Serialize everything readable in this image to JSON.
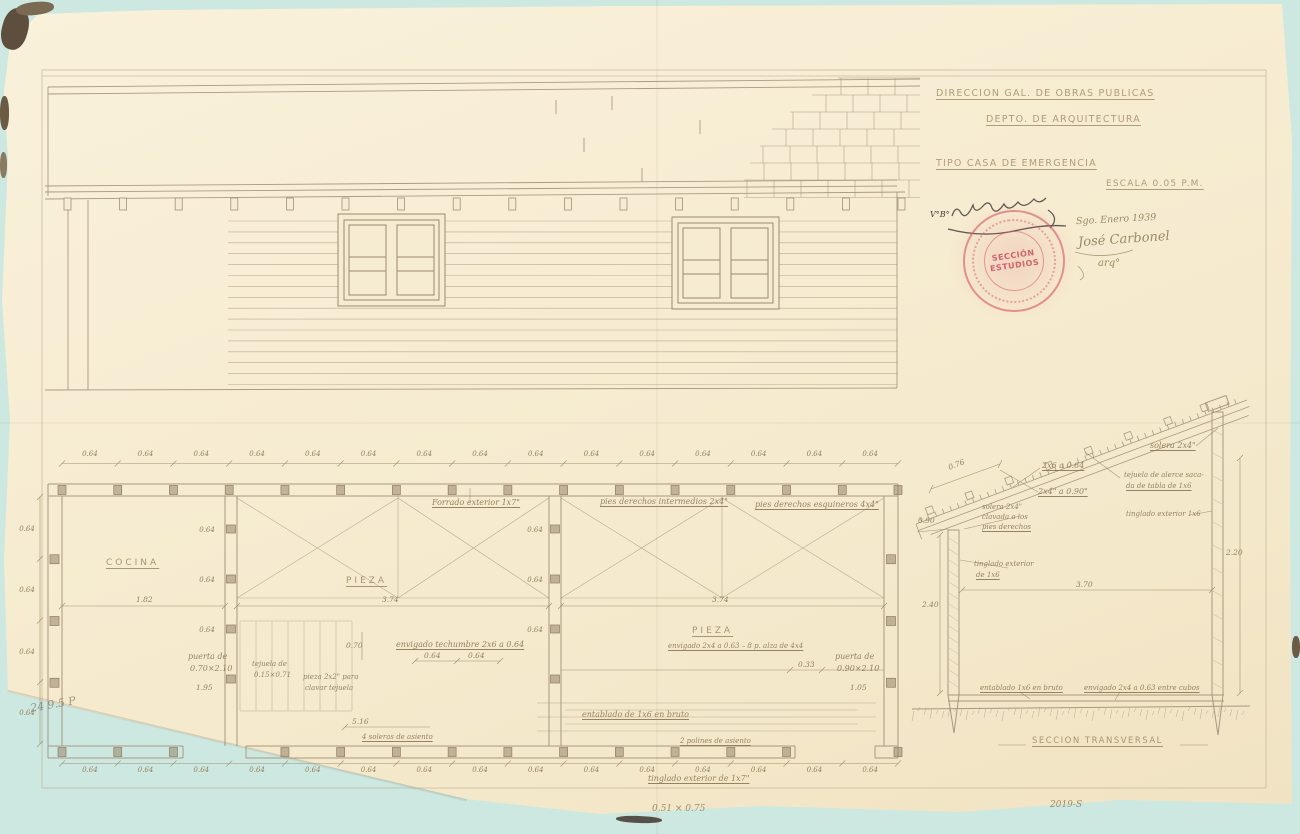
{
  "palette": {
    "background": "#cde8e1",
    "paper": "#f6ecd2",
    "line_color": "#a3917a",
    "handwriting_color": "#8d7a58",
    "ink_color": "#46413c",
    "stamp_red": "#d8586a"
  },
  "title_block": {
    "department_line1": "DIRECCION GAL. DE OBRAS PUBLICAS",
    "department_line2": "DEPTO. DE ARQUITECTURA",
    "project_title": "TIPO CASA DE EMERGENCIA",
    "scale": "ESCALA 0.05 P.M.",
    "approval_initials": "V°B°",
    "date_note": "Sgo. Enero 1939",
    "signature_name": "José Carbonel",
    "signature_title": "arq°",
    "stamp": {
      "line1": "SECCIÓN",
      "line2": "ESTUDIOS"
    }
  },
  "floor_plan": {
    "top_dims": [
      "0.64",
      "0.64",
      "0.64",
      "0.64",
      "0.64",
      "0.64",
      "0.64",
      "0.64",
      "0.64",
      "0.64",
      "0.64",
      "0.64",
      "0.64",
      "0.64",
      "0.64"
    ],
    "bottom_dims": [
      "0.64",
      "0.64",
      "0.64",
      "0.64",
      "0.64",
      "0.64",
      "0.64",
      "0.64",
      "0.64",
      "0.64",
      "0.64",
      "0.64",
      "0.64",
      "0.64",
      "0.64"
    ],
    "left_dims": [
      "0.64",
      "0.64",
      "0.64",
      "0.64"
    ],
    "partition1_dims": [
      "0.64",
      "0.64",
      "0.64"
    ],
    "partition2_dims": [
      "0.64",
      "0.64",
      "0.64"
    ],
    "rooms": {
      "kitchen": "COCINA",
      "room1": "PIEZA",
      "room2": "PIEZA"
    },
    "room_widths": {
      "kitchen": "1.82",
      "room1": "3.74",
      "room2": "3.74"
    },
    "notes": {
      "siding_top": "Forrado exterior 1x7\"",
      "studs_intermediate": "pies derechos intermedios 2x4\"",
      "studs_corner": "pies derechos esquineros 4x4\"",
      "ceiling_joists": "envigado techumbre 2x6 a 0.64",
      "joist_spacing_a": "0.64",
      "joist_spacing_b": "0.64",
      "dim_070": "0.70",
      "dim_516": "5.16",
      "door_left_1": "puerta de",
      "door_left_2": "0.70×2.10",
      "door_left_offset": "1.95",
      "shingle_1": "tejuela de",
      "shingle_2": "0.15×0.71",
      "shingle_batten_1": "pieza 2x2\" para",
      "shingle_batten_2": "clavar tejuela",
      "door_right_1": "puerta de",
      "door_right_2": "0.90×2.10",
      "door_right_offset": "1.05",
      "dim_033": "0.33",
      "floor_joists": "envigado 2x4 a 0.63 – 8 p. alza de 4x4",
      "floor_boards": "entablado de 1x6 en bruto",
      "sills_left": "4 soleras de asiento",
      "sills_right": "2 polines de asiento",
      "siding_bottom": "tinglado exterior de 1x7\""
    }
  },
  "section": {
    "title": "SECCION TRANSVERSAL",
    "notes": {
      "top_plate": "solera 2x4\"",
      "rafters": "2x6 a 0.64",
      "battens": "2x4\" a 0.90\"",
      "plate_note_1": "solera 2x4\"",
      "plate_note_2": "clavada a los",
      "plate_note_3": "pies derechos",
      "shingle_note_1": "tejuela de alerce saca-",
      "shingle_note_2": "da de tabla de 1x6",
      "siding_right": "tinglado exterior 1x6",
      "siding_left_1": "tinglado exterior",
      "siding_left_2": "de 1x6",
      "floor_boards": "entablado 1x6 en bruto",
      "floor_joists": "envigado 2x4 a 0.63 entre cubos"
    },
    "dims": {
      "rafter_spacing": "0.76",
      "eave": "0.90",
      "height_left": "2.40",
      "width": "3.70",
      "height_right": "2.20"
    }
  },
  "pencil_notes": {
    "bottom_left": "24 9.5 P",
    "bottom_center": "0.51 × 0.75",
    "sheet_number": "2019-S"
  }
}
